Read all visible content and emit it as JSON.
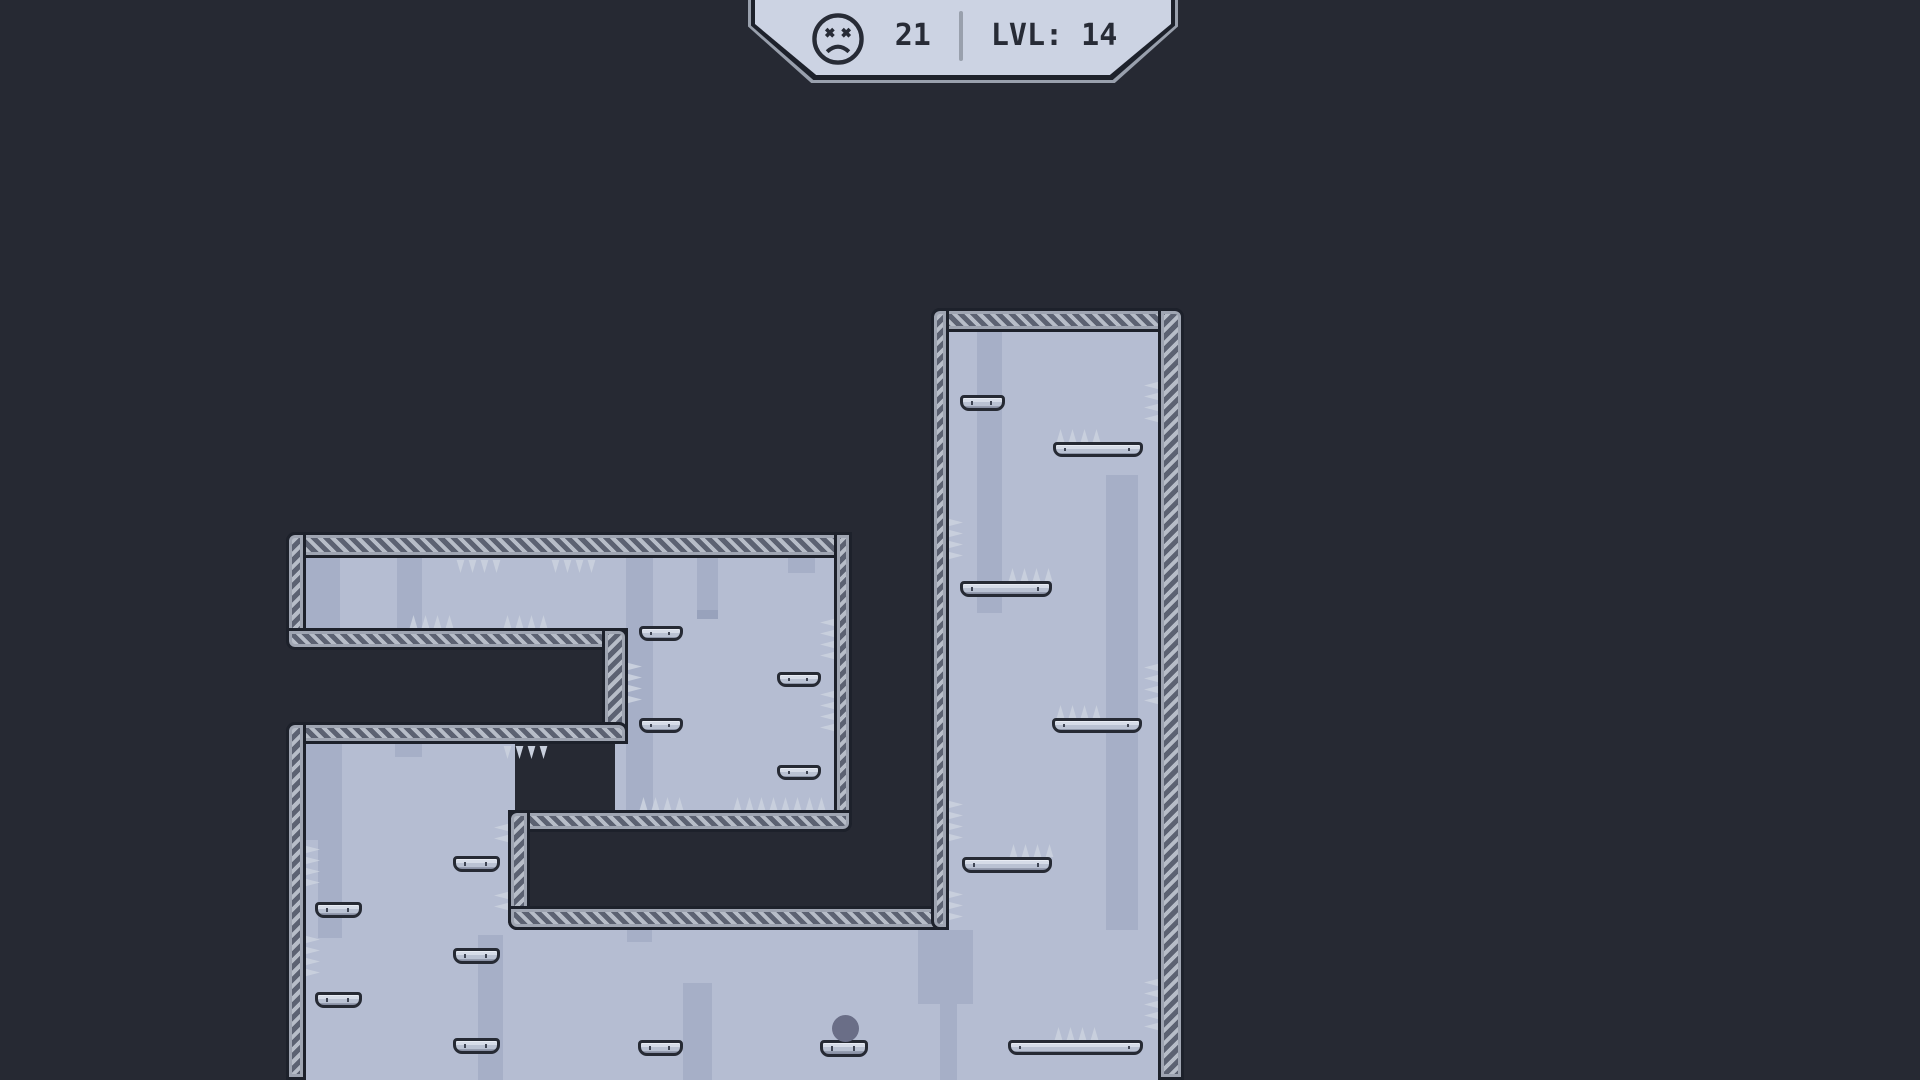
{
  "hud": {
    "deaths_count": "21",
    "level_label": "LVL: 14",
    "icon": "dead-face-icon"
  },
  "colors": {
    "bg": "#262933",
    "interior": "#b5bdd2",
    "stripe": "#a6afc7",
    "stripe-dark": "#98a2bc",
    "wall-border": "#1d212b",
    "wall-frame": "#9fa5b2",
    "hatch-dark": "#5c6272",
    "hatch-light": "#b7bdc8",
    "plat-border": "#262a34",
    "plat-seam": "#3f4554",
    "spike": "#c8cfdd",
    "spike-edge": "#363b48",
    "player": "#6a6e87",
    "hud-bevel": "#99a0ad",
    "hud-face": "#ccd3e3",
    "hud-text": "#272b36"
  },
  "level": {
    "interiors": [
      [
        300,
        540,
        540,
        90
      ],
      [
        615,
        540,
        225,
        275
      ],
      [
        300,
        735,
        215,
        345
      ],
      [
        300,
        912,
        865,
        168
      ],
      [
        943,
        315,
        222,
        765
      ]
    ],
    "stripes": [
      {
        "r": [
          306,
          558,
          34,
          70
        ]
      },
      {
        "r": [
          397,
          558,
          25,
          70
        ]
      },
      {
        "r": [
          626,
          558,
          27,
          252
        ]
      },
      {
        "r": [
          697,
          558,
          21,
          52
        ]
      },
      {
        "r": [
          697,
          610,
          21,
          9
        ],
        "shade": "dark"
      },
      {
        "r": [
          788,
          558,
          27,
          15
        ]
      },
      {
        "r": [
          306,
          744,
          36,
          96
        ]
      },
      {
        "r": [
          318,
          840,
          24,
          98
        ]
      },
      {
        "r": [
          395,
          744,
          27,
          13
        ]
      },
      {
        "r": [
          478,
          935,
          25,
          145
        ]
      },
      {
        "r": [
          683,
          983,
          29,
          97
        ]
      },
      {
        "r": [
          627,
          928,
          25,
          14
        ]
      },
      {
        "r": [
          918,
          930,
          55,
          74
        ]
      },
      {
        "r": [
          940,
          1004,
          17,
          76
        ]
      },
      {
        "r": [
          977,
          332,
          25,
          281
        ]
      },
      {
        "r": [
          1106,
          475,
          32,
          455
        ]
      }
    ],
    "walls": [
      {
        "x": 286,
        "y": 532,
        "w": 566,
        "h": 26,
        "o": "h",
        "rad": "9px 9px 0 0"
      },
      {
        "x": 286,
        "y": 532,
        "w": 20,
        "h": 116,
        "o": "v",
        "rad": "9px 0 0 9px"
      },
      {
        "x": 286,
        "y": 628,
        "w": 342,
        "h": 22,
        "o": "h",
        "rad": "0 0 9px 9px"
      },
      {
        "x": 602,
        "y": 628,
        "w": 26,
        "h": 116,
        "o": "v",
        "rad": "0 9px 9px 0"
      },
      {
        "x": 286,
        "y": 722,
        "w": 342,
        "h": 22,
        "o": "h",
        "rad": "9px 9px 0 0"
      },
      {
        "x": 286,
        "y": 722,
        "w": 20,
        "h": 358,
        "o": "v",
        "rad": "9px 0 0 0"
      },
      {
        "x": 834,
        "y": 532,
        "w": 18,
        "h": 300,
        "o": "v",
        "rad": "0 0 9px 0"
      },
      {
        "x": 508,
        "y": 810,
        "w": 344,
        "h": 22,
        "o": "h",
        "rad": "0 0 9px 9px"
      },
      {
        "x": 508,
        "y": 810,
        "w": 22,
        "h": 120,
        "o": "v",
        "rad": "9px 0 0 9px"
      },
      {
        "x": 508,
        "y": 906,
        "w": 441,
        "h": 24,
        "o": "h",
        "rad": "0 0 9px 9px"
      },
      {
        "x": 931,
        "y": 308,
        "w": 253,
        "h": 24,
        "o": "h",
        "rad": "9px 9px 0 0"
      },
      {
        "x": 931,
        "y": 308,
        "w": 18,
        "h": 622,
        "o": "v",
        "rad": "9px 0 0 9px"
      },
      {
        "x": 1158,
        "y": 308,
        "w": 26,
        "h": 772,
        "o": "v",
        "rad": "0 9px 0 0"
      }
    ],
    "platforms": [
      [
        639,
        626,
        44,
        15
      ],
      [
        639,
        718,
        44,
        15
      ],
      [
        777,
        672,
        44,
        15
      ],
      [
        777,
        765,
        44,
        15
      ],
      [
        315,
        902,
        47,
        16
      ],
      [
        315,
        992,
        47,
        16
      ],
      [
        453,
        856,
        47,
        16
      ],
      [
        453,
        948,
        47,
        16
      ],
      [
        453,
        1038,
        47,
        16
      ],
      [
        638,
        1040,
        45,
        16
      ],
      [
        820,
        1040,
        48,
        17
      ],
      [
        1008,
        1040,
        135,
        15
      ],
      [
        960,
        395,
        45,
        16
      ],
      [
        1053,
        442,
        90,
        15
      ],
      [
        960,
        581,
        92,
        16
      ],
      [
        1052,
        718,
        90,
        15
      ],
      [
        962,
        857,
        90,
        16
      ]
    ],
    "spikes": [
      {
        "x": 455,
        "y": 560,
        "dir": "down",
        "count": 4
      },
      {
        "x": 550,
        "y": 560,
        "dir": "down",
        "count": 4
      },
      {
        "x": 502,
        "y": 746,
        "dir": "down",
        "count": 4
      },
      {
        "x": 408,
        "y": 615,
        "dir": "up",
        "count": 4
      },
      {
        "x": 502,
        "y": 615,
        "dir": "up",
        "count": 4
      },
      {
        "x": 638,
        "y": 797,
        "dir": "up",
        "count": 4
      },
      {
        "x": 732,
        "y": 797,
        "dir": "up",
        "count": 8
      },
      {
        "x": 1055,
        "y": 429,
        "dir": "up",
        "count": 4
      },
      {
        "x": 1007,
        "y": 568,
        "dir": "up",
        "count": 4
      },
      {
        "x": 1055,
        "y": 705,
        "dir": "up",
        "count": 4
      },
      {
        "x": 1008,
        "y": 844,
        "dir": "up",
        "count": 4
      },
      {
        "x": 1053,
        "y": 1027,
        "dir": "up",
        "count": 4
      },
      {
        "x": 306,
        "y": 845,
        "dir": "right",
        "count": 4
      },
      {
        "x": 306,
        "y": 935,
        "dir": "right",
        "count": 4
      },
      {
        "x": 628,
        "y": 662,
        "dir": "right",
        "count": 4
      },
      {
        "x": 949,
        "y": 518,
        "dir": "right",
        "count": 4
      },
      {
        "x": 949,
        "y": 800,
        "dir": "right",
        "count": 4
      },
      {
        "x": 949,
        "y": 890,
        "dir": "right",
        "count": 3
      },
      {
        "x": 820,
        "y": 618,
        "dir": "left",
        "count": 4
      },
      {
        "x": 820,
        "y": 690,
        "dir": "left",
        "count": 4
      },
      {
        "x": 1144,
        "y": 381,
        "dir": "left",
        "count": 4
      },
      {
        "x": 1144,
        "y": 663,
        "dir": "left",
        "count": 4
      },
      {
        "x": 1144,
        "y": 978,
        "dir": "left",
        "count": 5
      },
      {
        "x": 494,
        "y": 823,
        "dir": "left",
        "count": 2
      },
      {
        "x": 494,
        "y": 891,
        "dir": "left",
        "count": 2
      }
    ],
    "player": {
      "x": 832,
      "y": 1015,
      "w": 27,
      "h": 27
    }
  }
}
